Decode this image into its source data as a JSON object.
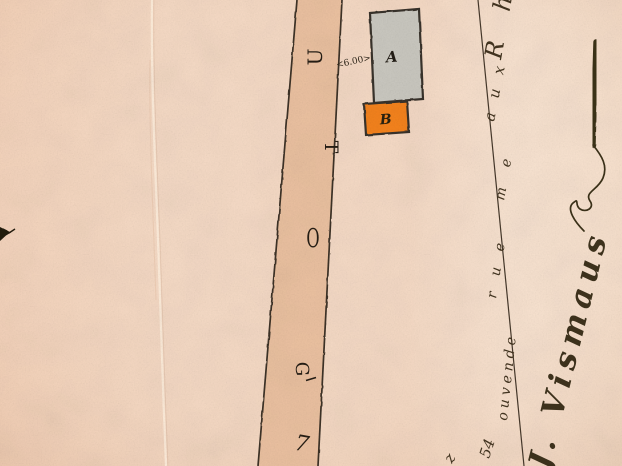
{
  "document_kind": "scanned hand-drawn survey map (aged paper)",
  "map": {
    "dimension_label": "<6.00>",
    "buildings": [
      {
        "label": "A",
        "fill": "#cbc9c1"
      },
      {
        "label": "B",
        "fill": "#f5831f"
      }
    ],
    "road": {
      "fill": "#ecc2a1",
      "glyphs": [
        "U",
        "T",
        "O",
        "G",
        "7"
      ],
      "glyphs_note": "letters drawn rotated along the road"
    }
  },
  "handwriting": {
    "diagonal_segments": [
      "z",
      "54",
      "ouvende",
      "rue",
      "me",
      "aux",
      "Rh"
    ],
    "diagonal_note": "cursive annotation written along the survey line, rotated, partially legible",
    "signature": "J. Vismaus",
    "signature_note": "large rotated ink signature with underline flourish, partially legible"
  },
  "colors": {
    "paper": "#f6dbc6",
    "road_fill": "#ecc2a1",
    "building_a_fill": "#cbc9c1",
    "building_b_fill": "#f5831f",
    "outline_ink": "#39302a",
    "handwriting_ink": "#43341f"
  }
}
